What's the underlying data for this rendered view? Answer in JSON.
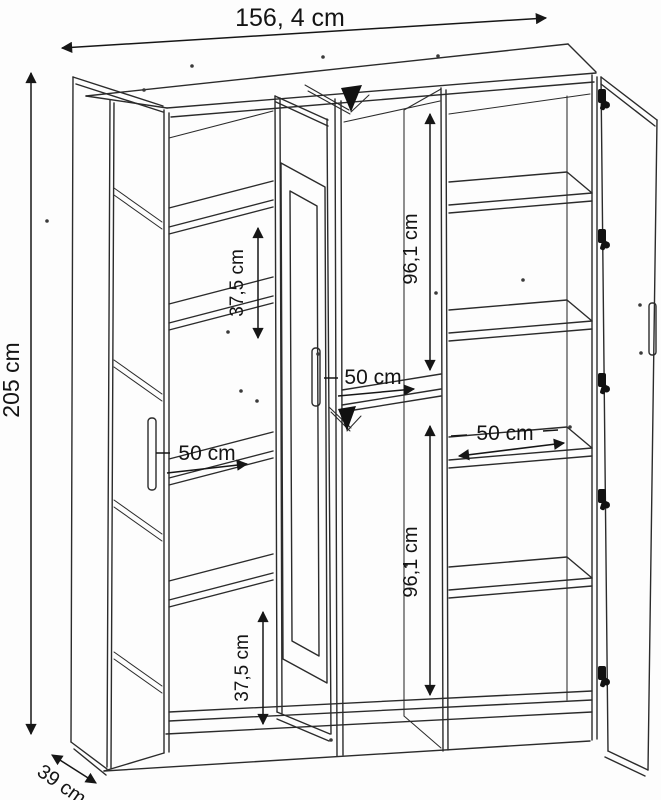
{
  "diagram": {
    "subject": "three-door wardrobe with open doors, technical dimension drawing",
    "style": "black line drawing on white background",
    "background_color": "#fdfdfd",
    "line_color": "#2b2b2b",
    "text_color": "#141414"
  },
  "labels": {
    "width": "156, 4 cm",
    "height": "205 cm",
    "depth": "39 cm",
    "gap_top_left": "37,5 cm",
    "gap_bottom_left": "37,5 cm",
    "hang_top": "96,1 cm",
    "hang_bottom": "96,1 cm",
    "shelf_left": "50 cm",
    "shelf_middle": "50 cm",
    "shelf_right": "50 cm"
  },
  "values_cm": {
    "overall_width": 156.4,
    "overall_height": 205,
    "overall_depth": 39,
    "shelf_spacing": 37.5,
    "hanging_section_height": 96.1,
    "section_inner_width": 50
  }
}
